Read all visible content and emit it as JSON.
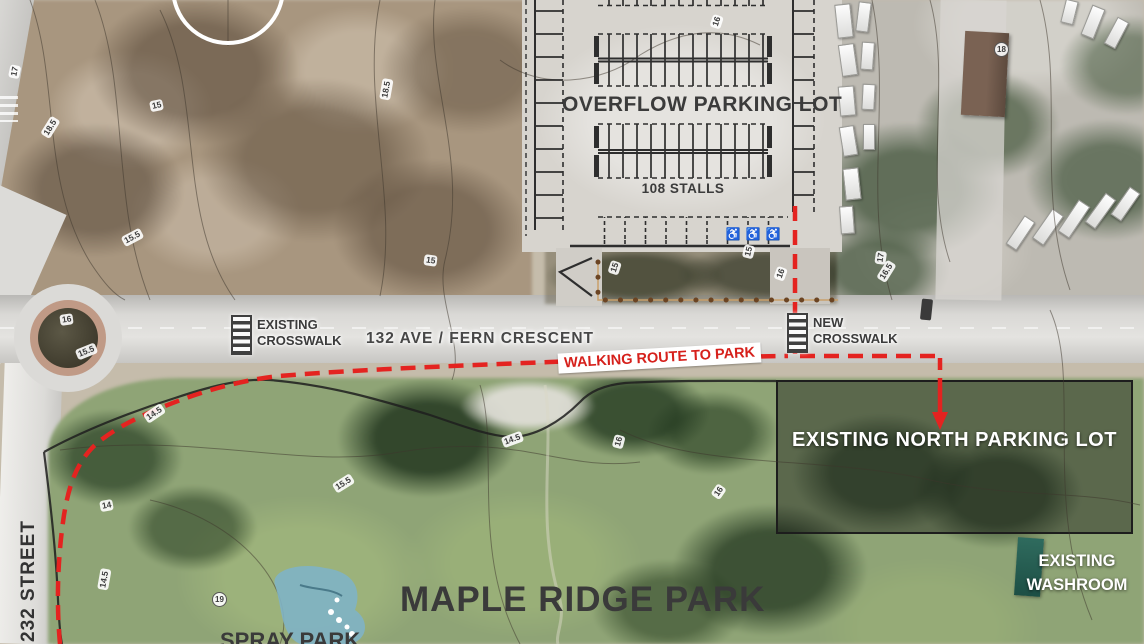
{
  "parking_lot": {
    "title": "OVERFLOW PARKING LOT",
    "stalls": "108 STALLS"
  },
  "crosswalk_existing": {
    "line1": "EXISTING",
    "line2": "CROSSWALK"
  },
  "crosswalk_new": {
    "line1": "NEW",
    "line2": "CROSSWALK"
  },
  "streets": {
    "main": "132 AVE / FERN CRESCENT",
    "side": "232 STREET"
  },
  "route": {
    "label": "WALKING ROUTE TO PARK"
  },
  "north_lot": {
    "line1": "EXISTING",
    "line2": "NORTH",
    "line3": "PARKING LOT"
  },
  "washroom": {
    "line1": "EXISTING",
    "line2": "WASHROOM"
  },
  "park": {
    "name": "MAPLE RIDGE PARK",
    "spray_park": "SPRAY PARK"
  },
  "icons": {
    "accessible": "♿"
  },
  "colors": {
    "route_red": "#e42320",
    "route_label_red": "#d6201b",
    "dark_text": "#3b3b3b",
    "white_text": "#ffffff",
    "overlay_box": "rgba(20,22,18,0.42)",
    "path_dots_brown": "#6b4423"
  },
  "contours": [
    {
      "v": "17"
    },
    {
      "v": "18.5"
    },
    {
      "v": "15"
    },
    {
      "v": "15.5"
    },
    {
      "v": "16"
    },
    {
      "v": "15.5"
    },
    {
      "v": "14.5"
    },
    {
      "v": "18.5"
    },
    {
      "v": "15"
    },
    {
      "v": "16"
    },
    {
      "v": "15"
    },
    {
      "v": "16"
    },
    {
      "v": "15"
    },
    {
      "v": "17"
    },
    {
      "v": "16.5"
    },
    {
      "v": "18"
    },
    {
      "v": "14"
    },
    {
      "v": "14.5"
    },
    {
      "v": "19"
    },
    {
      "v": "14.5"
    },
    {
      "v": "15.5"
    },
    {
      "v": "16"
    },
    {
      "v": "16"
    }
  ]
}
